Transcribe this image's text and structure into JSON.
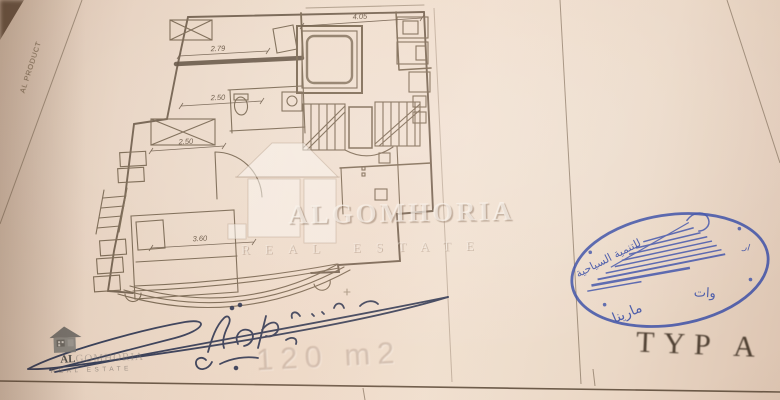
{
  "sheet": {
    "border_text": "AL PRODUCT",
    "type_label": "TYP A",
    "area_label": "120 m2"
  },
  "plan": {
    "dims": {
      "top": "2.79",
      "mid": "2.50",
      "lower": "2.50",
      "width_top": "4.05",
      "bottom": "3.60"
    }
  },
  "watermark": {
    "title": "ALGOMHORIA",
    "subtitle": "REAL ESTATE"
  },
  "corner_logo": {
    "prefix": "AL",
    "rest": "GOMHORIA",
    "subtitle": "REAL ESTATE"
  },
  "stamp": {
    "top_text": "للتنمية السياحية",
    "top_fragment": "ار",
    "bottom_text": "مارينا",
    "bottom_fragment": "وات",
    "ink_color": "#3a4ea6"
  },
  "signature": {
    "ink_color": "#2b3450"
  },
  "colors": {
    "paper": "#ecd9c7",
    "plan_line": "#77654f",
    "text_brown": "#4e3f31"
  }
}
